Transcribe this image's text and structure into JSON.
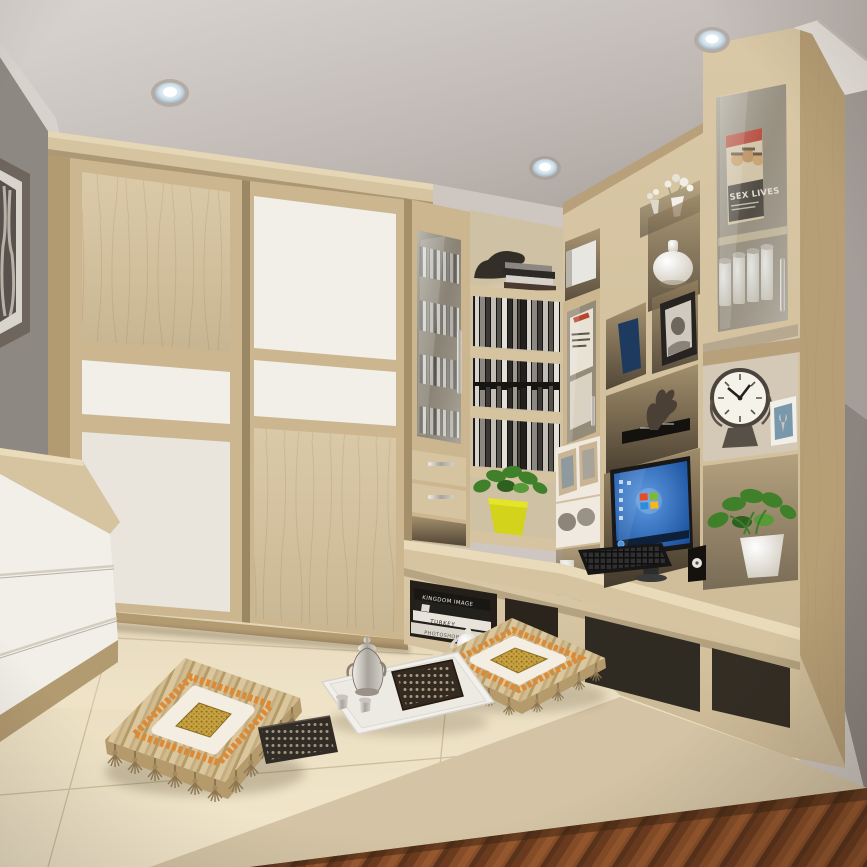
{
  "scene": {
    "title": "tatami-bedroom-interior",
    "texts": {
      "magazine_title": "SEX LIVES",
      "book_spine_1": "KINGDOM IMAGE",
      "book_spine_2": "TURKEY",
      "book_spine_3": "PHOTOSHOP"
    },
    "colors": {
      "ceiling": "#cdc6c1",
      "wall_left": "#8e8883",
      "wall_right": "#a49d98",
      "wood": "#d6c4a1",
      "wood_frame": "#cbb68f",
      "wood_dark": "#b29a71",
      "panel_white": "#f2efe8",
      "floor": "#e9dcbf",
      "parquet": "#7e4a26",
      "screen": "#1d66c2",
      "pot_yellow": "#d2d31a",
      "plant": "#41802b",
      "navy_book": "#1e3a5e",
      "cushion_orange": "#dd8a35",
      "cushion_gold": "#c8a23e",
      "cushion_cream": "#f3eee1",
      "cushion_base": "#d8c49c"
    }
  }
}
